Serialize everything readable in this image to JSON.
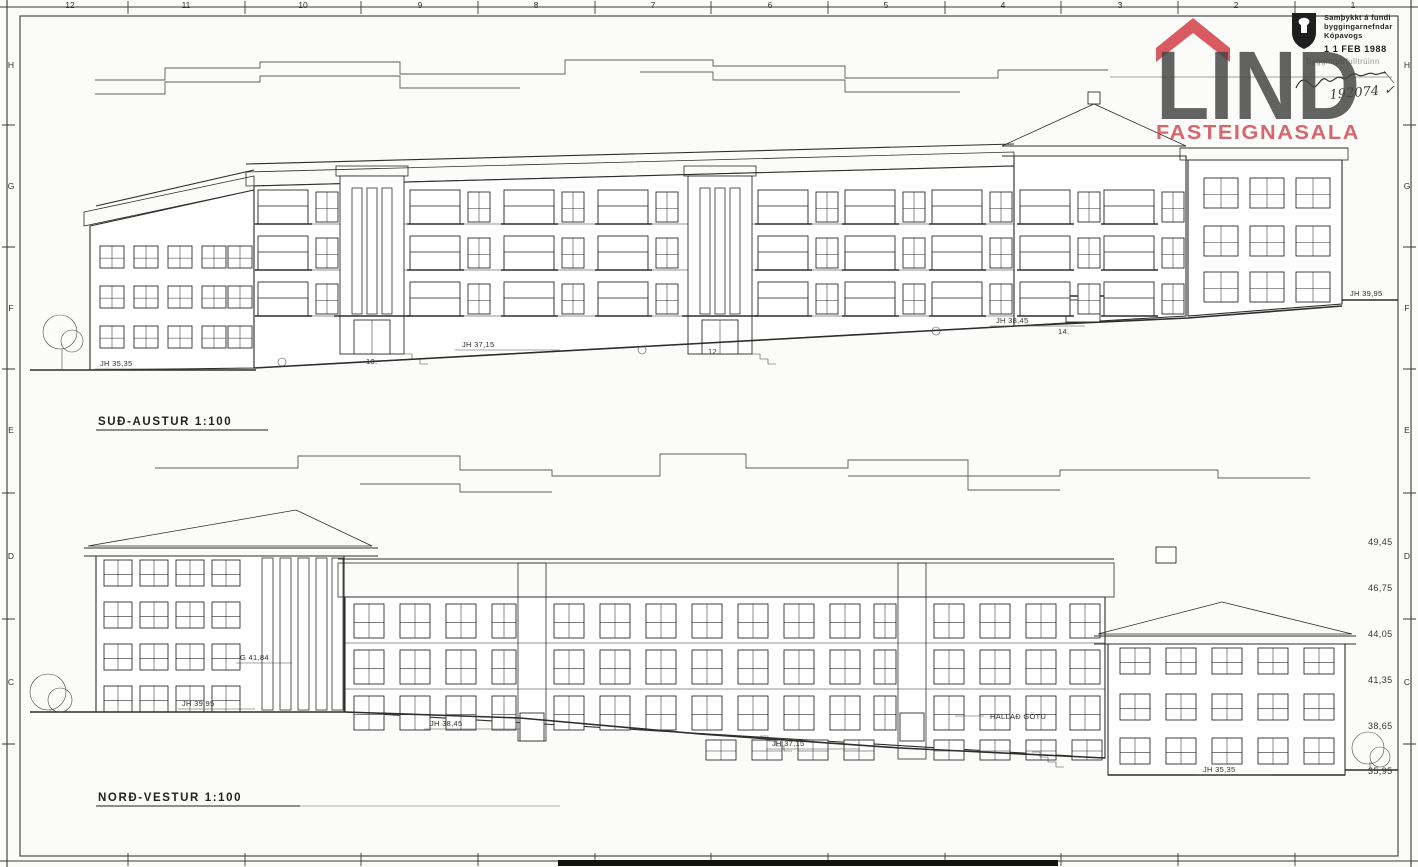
{
  "logo": {
    "name": "LIND",
    "subtitle": "FASTEIGNASALA",
    "roof_color": "#d64d54",
    "text_color": "#4a4a4a"
  },
  "stamp": {
    "line1": "Samþykkt á fundi",
    "line2": "byggingarnefndar",
    "line3": "Kópavogs",
    "date": "1 1  FEB 1988",
    "official": "Byggingarfulltrúinn",
    "number": "192074",
    "check": "✓"
  },
  "labels": {
    "top_elevation": "SUÐ-AUSTUR  1:100",
    "bottom_elevation": "NORÐ-VESTUR  1:100"
  },
  "grid": {
    "top_numbers": [
      "12",
      "11",
      "10",
      "9",
      "8",
      "7",
      "6",
      "5",
      "4",
      "3",
      "2",
      "1"
    ],
    "side_letters": [
      "H",
      "G",
      "F",
      "E",
      "D",
      "C"
    ]
  },
  "elevation_scale": [
    "49,45",
    "46,75",
    "44,05",
    "41,35",
    "38,65",
    "35,95"
  ],
  "annotations": {
    "top": {
      "jh_left": "JH 35,35",
      "jh_mid": "JH 37,15",
      "jh_right": "JH 38,45",
      "jh_far_right": "JH 39,95",
      "house_1": "10.",
      "house_2": "12.",
      "house_3": "14."
    },
    "bottom": {
      "g_mark": "G 41,84",
      "jh_left": "JH 39,95",
      "jh_mid_left": "JH 38,45",
      "jh_mid": "JH 37,15",
      "street": "HALLAÐ GÖTU",
      "jh_right": "JH 35,35"
    }
  }
}
